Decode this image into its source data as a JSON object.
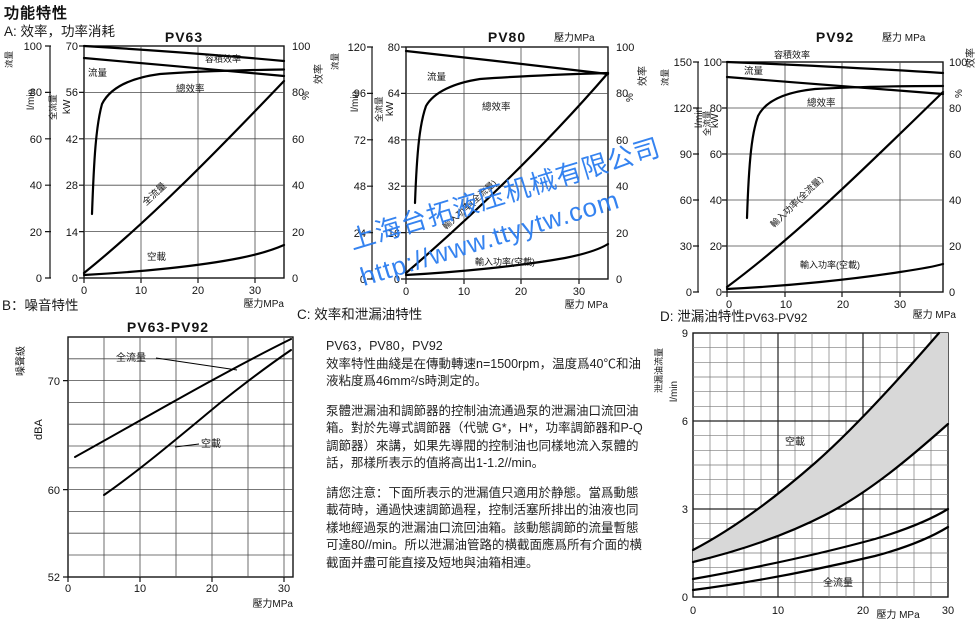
{
  "page": {
    "title": "功能特性",
    "section_a": "A: 效率，功率消耗",
    "section_b": "B：噪音特性",
    "section_c": "C: 效率和泄漏油特性",
    "section_d": "D: 泄漏油特性",
    "section_d_sub": "PV63-PV92"
  },
  "watermark": {
    "line1": "上海台拓液压机械有限公司",
    "line2": "http://www.ttyytw.com",
    "color": "#2b7df0"
  },
  "c_text": {
    "models": "PV63，PV80，PV92",
    "p1": "效率特性曲綫是在傳動轉速n=1500rpm，温度爲40℃和油液粘度爲46mm²/s時測定的。",
    "p2": "泵體泄漏油和調節器的控制油流通過泵的泄漏油口流回油箱。對於先導式調節器（代號 G*，H*，功率調節器和P-Q調節器）來講，如果先導閥的控制油也同樣地流入泵體的話，那樣所表示的值將高出1-1.2//min。",
    "p3": "請您注意：下面所表示的泄漏值只適用於静態。當爲動態載荷時，通過快速調節過程，控制活塞所排出的油液也同樣地經過泵的泄漏油口流回油箱。該動態調節的流量暫態可達80//min。所以泄漏油管路的横截面應爲所有介面的横截面并盡可能直接及短地與油箱相連。"
  },
  "chart_data": [
    {
      "id": "PV63",
      "type": "line",
      "title": "PV63",
      "xlabel": "壓力MPa",
      "x_range": [
        0,
        35
      ],
      "x_ticks": [
        "0",
        "10",
        "20",
        "30"
      ],
      "flow_label": "流量",
      "flow_unit": "l/min",
      "flow_ticks": [
        "100",
        "80",
        "60",
        "40",
        "20",
        "0"
      ],
      "power_label": "全流量",
      "power_unit": "kW",
      "power_ticks": [
        "70",
        "56",
        "42",
        "28",
        "14",
        "0"
      ],
      "eff_label": "效率",
      "eff_unit": "%",
      "eff_ticks": [
        "100",
        "80",
        "60",
        "40",
        "20",
        "0"
      ],
      "curve_labels": {
        "vol_eff": "容積效率",
        "flow": "流量",
        "total_eff": "總效率",
        "input_full": "全流量",
        "input_idle": "空載"
      },
      "series": [
        {
          "name": "容積效率",
          "unit": "%",
          "x": [
            0,
            10,
            20,
            30,
            35
          ],
          "y": [
            100,
            98,
            96.5,
            94.5,
            93.5
          ]
        },
        {
          "name": "流量",
          "unit": "l/min",
          "x": [
            0,
            10,
            20,
            30,
            35
          ],
          "y": [
            95,
            92.5,
            90.5,
            88.5,
            87
          ]
        },
        {
          "name": "總效率",
          "unit": "%",
          "x": [
            2,
            3,
            4,
            6,
            10,
            20,
            30,
            35
          ],
          "y": [
            27,
            55,
            75,
            83,
            86,
            88.5,
            89.5,
            90
          ]
        },
        {
          "name": "輸入功率(全流量)",
          "unit": "kW",
          "x": [
            0,
            10,
            20,
            30,
            35
          ],
          "y": [
            1.5,
            17,
            33,
            49,
            58
          ]
        },
        {
          "name": "輸入功率(空載)",
          "unit": "kW",
          "x": [
            0,
            10,
            20,
            30,
            35
          ],
          "y": [
            1,
            2.5,
            4.5,
            7.5,
            10
          ]
        }
      ]
    },
    {
      "id": "PV80",
      "type": "line",
      "title": "PV80",
      "xlabel_top": "壓力MPa",
      "xlabel": "壓力 MPa",
      "x_range": [
        0,
        35
      ],
      "x_ticks": [
        "0",
        "10",
        "20",
        "30"
      ],
      "flow_label": "流量",
      "flow_unit": "l/min",
      "flow_ticks": [
        "120",
        "96",
        "72",
        "48",
        "24",
        "0"
      ],
      "power_label": "全流量",
      "power_unit": "kW",
      "power_ticks": [
        "80",
        "64",
        "48",
        "32",
        "16",
        "0"
      ],
      "eff_label": "效率",
      "eff_unit": "%",
      "eff_ticks": [
        "100",
        "80",
        "60",
        "40",
        "20",
        "0"
      ],
      "curve_labels": {
        "flow": "流量",
        "total_eff": "總效率",
        "input_full": "輸入功率(全流量)",
        "input_idle": "輸入功率(空載)"
      },
      "series": [
        {
          "name": "流量",
          "unit": "l/min",
          "x": [
            0,
            10,
            20,
            30,
            35
          ],
          "y": [
            118,
            115,
            112,
            108,
            106
          ]
        },
        {
          "name": "總效率",
          "unit": "%",
          "x": [
            3,
            4,
            6,
            10,
            20,
            30,
            35
          ],
          "y": [
            33,
            70,
            82,
            86,
            88,
            88.5,
            89
          ]
        },
        {
          "name": "輸入功率(全流量)",
          "unit": "kW",
          "x": [
            0,
            10,
            20,
            30,
            35
          ],
          "y": [
            2,
            21,
            41,
            61,
            71
          ]
        },
        {
          "name": "輸入功率(空載)",
          "unit": "kW",
          "x": [
            0,
            10,
            20,
            30,
            35
          ],
          "y": [
            1.5,
            3,
            5.5,
            9,
            12
          ]
        }
      ]
    },
    {
      "id": "PV92",
      "type": "line",
      "title": "PV92",
      "xlabel_top": "壓力 MPa",
      "xlabel": "壓力 MPa",
      "x_range": [
        0,
        35
      ],
      "x_ticks": [
        "0",
        "10",
        "20",
        "30"
      ],
      "flow_label": "流量",
      "flow_unit": "l/min",
      "flow_ticks": [
        "150",
        "120",
        "90",
        "60",
        "30",
        "0"
      ],
      "power_label": "全流量",
      "power_unit": "kW",
      "power_ticks": [
        "100",
        "80",
        "60",
        "40",
        "20",
        "0"
      ],
      "eff_label": "效率",
      "eff_unit": "%",
      "eff_ticks": [
        "100",
        "80",
        "60",
        "40",
        "20",
        "0"
      ],
      "curve_labels": {
        "vol_eff": "容積效率",
        "flow": "流量",
        "total_eff": "總效率",
        "input_full": "輸入功率(全流量)",
        "input_idle": "輸入功率(空載)"
      },
      "series": [
        {
          "name": "容積效率",
          "unit": "%",
          "x": [
            0,
            10,
            20,
            30,
            35
          ],
          "y": [
            100,
            98.5,
            97,
            95.5,
            95
          ]
        },
        {
          "name": "流量",
          "unit": "l/min",
          "x": [
            0,
            10,
            20,
            30,
            35
          ],
          "y": [
            140,
            137,
            134,
            131,
            129
          ]
        },
        {
          "name": "總效率",
          "unit": "%",
          "x": [
            3.5,
            5,
            8,
            15,
            25,
            35
          ],
          "y": [
            32,
            75,
            85,
            88,
            89,
            89.5
          ]
        },
        {
          "name": "輸入功率(全流量)",
          "unit": "kW",
          "x": [
            0,
            10,
            20,
            30,
            35
          ],
          "y": [
            2,
            26,
            50,
            74,
            87
          ]
        },
        {
          "name": "輸入功率(空載)",
          "unit": "kW",
          "x": [
            0,
            10,
            20,
            30,
            35
          ],
          "y": [
            1.5,
            3,
            5.5,
            9,
            12
          ]
        }
      ]
    },
    {
      "id": "PV63-PV92-noise",
      "type": "line",
      "title": "PV63-PV92",
      "ylabel": "噪聲級",
      "yunit": "dBA",
      "y_ticks": [
        "70",
        "60",
        "52"
      ],
      "y_range": [
        52,
        74
      ],
      "xlabel": "壓力MPa",
      "x_ticks": [
        "0",
        "10",
        "20",
        "30"
      ],
      "x_range": [
        0,
        31
      ],
      "curve_labels": {
        "full": "全流量",
        "idle": "空載"
      },
      "series": [
        {
          "name": "全流量",
          "x": [
            1,
            10,
            20,
            31
          ],
          "y": [
            63,
            66.5,
            70.5,
            73.5
          ]
        },
        {
          "name": "空載",
          "x": [
            5,
            10,
            20,
            31
          ],
          "y": [
            59.5,
            62,
            67.5,
            72.5
          ]
        }
      ]
    },
    {
      "id": "PV63-PV92-leak",
      "type": "band",
      "title": "PV63-PV92",
      "ylabel": "泄漏油流量",
      "yunit": "l/min",
      "y_ticks": [
        "9",
        "6",
        "3",
        "0"
      ],
      "y_range": [
        0,
        9
      ],
      "xlabel": "壓力 MPa",
      "x_ticks": [
        "0",
        "10",
        "20",
        "30"
      ],
      "x_range": [
        0,
        30
      ],
      "curve_labels": {
        "idle": "空載",
        "full": "全流量"
      },
      "bands": [
        {
          "name": "空載",
          "shaded": true,
          "upper_x": [
            0,
            10,
            20,
            29
          ],
          "upper_y": [
            1.6,
            3.5,
            6.2,
            9
          ],
          "lower_x": [
            0,
            10,
            20,
            30
          ],
          "lower_y": [
            1.2,
            2.4,
            4.0,
            5.9
          ]
        },
        {
          "name": "全流量",
          "shaded": false,
          "upper_x": [
            0,
            10,
            20,
            30
          ],
          "upper_y": [
            0.6,
            1.3,
            2.1,
            3.0
          ],
          "lower_x": [
            0,
            10,
            20,
            30
          ],
          "lower_y": [
            0.25,
            0.7,
            1.5,
            2.4
          ]
        }
      ]
    }
  ]
}
